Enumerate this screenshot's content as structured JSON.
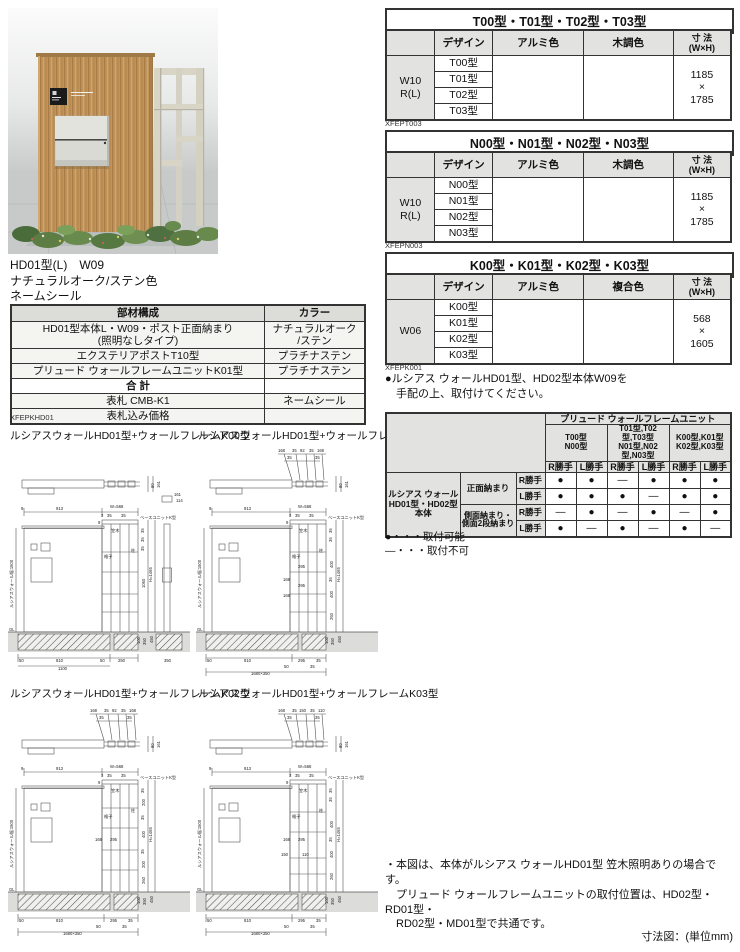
{
  "photo": {
    "caption_line1": "HD01型(L)　W09",
    "caption_line2": "ナチュラルオーク/ステン色",
    "caption_line3": "ネームシール"
  },
  "spec_tables": [
    {
      "title": "T00型・T01型・T02型・T03型",
      "headers": {
        "design": "デザイン",
        "alumi": "アルミ色",
        "wood": "木調色",
        "size": "寸 法\n(W×H)"
      },
      "row_label": "W10\nR(L)",
      "designs": [
        "T00型",
        "T01型",
        "T02型",
        "T03型"
      ],
      "size": "1185\n×\n1785",
      "code": "XFEPT003"
    },
    {
      "title": "N00型・N01型・N02型・N03型",
      "headers": {
        "design": "デザイン",
        "alumi": "アルミ色",
        "wood": "木調色",
        "size": "寸 法\n(W×H)"
      },
      "row_label": "W10\nR(L)",
      "designs": [
        "N00型",
        "N01型",
        "N02型",
        "N03型"
      ],
      "size": "1185\n×\n1785",
      "code": "XFEPN003"
    },
    {
      "title": "K00型・K01型・K02型・K03型",
      "headers": {
        "design": "デザイン",
        "alumi": "アルミ色",
        "wood": "複合色",
        "size": "寸 法\n(W×H)"
      },
      "row_label": "W06",
      "designs": [
        "K00型",
        "K01型",
        "K02型",
        "K03型"
      ],
      "size": "568\n×\n1605",
      "code": "XFEPK001"
    }
  ],
  "order_note": "●ルシアス ウォールHD01型、HD02型本体W09を\n　手配の上、取付けてください。",
  "parts_table": {
    "headers": {
      "parts": "部材構成",
      "color": "カラー"
    },
    "rows": [
      {
        "name": "HD01型本体L・W09・ポスト正面納まり\n(照明なしタイプ)",
        "color": "ナチュラルオーク\n/ステン"
      },
      {
        "name": "エクステリアポストT10型",
        "color": "プラチナステン"
      },
      {
        "name": "プリュード ウォールフレームユニットK01型",
        "color": "プラチナステン"
      },
      {
        "name": "合 計",
        "color": ""
      },
      {
        "name": "表札 CMB-K1",
        "color": "ネームシール"
      },
      {
        "name": "表札込み価格",
        "color": ""
      }
    ],
    "code": "XFEPKHD01"
  },
  "compat": {
    "title": "プリュード ウォールフレームユニット",
    "groups": [
      "T00型\nN00型",
      "T01型,T02型,T03型\nN01型,N02型,N03型",
      "K00型,K01型\nK02型,K03型"
    ],
    "hands": [
      "R勝手",
      "L勝手",
      "R勝手",
      "L勝手",
      "R勝手",
      "L勝手"
    ],
    "body_label": "ルシアス ウォール\nHD01型・HD02型\n本体",
    "mount_front": "正面納まり",
    "mount_side": "側面納まり・\n側面2段納まり",
    "rows": [
      {
        "hand": "R勝手",
        "cells": [
          "●",
          "●",
          "―",
          "●",
          "●",
          "●"
        ]
      },
      {
        "hand": "L勝手",
        "cells": [
          "●",
          "●",
          "●",
          "―",
          "●",
          "●"
        ]
      },
      {
        "hand": "R勝手",
        "cells": [
          "―",
          "●",
          "―",
          "●",
          "―",
          "●"
        ]
      },
      {
        "hand": "L勝手",
        "cells": [
          "●",
          "―",
          "●",
          "―",
          "●",
          "―"
        ]
      }
    ],
    "legend_ok": "●・・・取付可能",
    "legend_ng": "―・・・取付不可"
  },
  "drawings": [
    {
      "title": "ルシアスウォールHD01型+ウォールフレームK00型",
      "texts": [
        {
          "t": "80",
          "x": 146,
          "y": 48,
          "r": -90
        },
        {
          "t": "161",
          "x": 152,
          "y": 48,
          "r": -90
        },
        {
          "t": "161",
          "x": 166,
          "y": 56
        },
        {
          "t": "114",
          "x": 168,
          "y": 62
        },
        {
          "t": "9",
          "x": 13,
          "y": 70
        },
        {
          "t": "913",
          "x": 48,
          "y": 70
        },
        {
          "t": "W=568",
          "x": 102,
          "y": 68
        },
        {
          "t": "3",
          "x": 93,
          "y": 77
        },
        {
          "t": "35",
          "x": 99,
          "y": 77
        },
        {
          "t": "35",
          "x": 113,
          "y": 77
        },
        {
          "t": "9",
          "x": 90,
          "y": 84
        },
        {
          "t": "笠木",
          "x": 103,
          "y": 92,
          "s": 3.6
        },
        {
          "t": "ベースユニットK型",
          "x": 132,
          "y": 79,
          "s": 3.3
        },
        {
          "t": "格子",
          "x": 96,
          "y": 118,
          "s": 3.6
        },
        {
          "t": "柱",
          "x": 123,
          "y": 112,
          "s": 3.6
        },
        {
          "t": "35",
          "x": 136,
          "y": 93,
          "r": -90,
          "s": 3.5
        },
        {
          "t": "35",
          "x": 136,
          "y": 102,
          "r": -90,
          "s": 3.5
        },
        {
          "t": "35",
          "x": 136,
          "y": 111,
          "r": -90,
          "s": 3.5
        },
        {
          "t": "1060",
          "x": 137,
          "y": 148,
          "r": -90
        },
        {
          "t": "H=1465",
          "x": 144,
          "y": 142,
          "r": -90
        },
        {
          "t": "100",
          "x": 132,
          "y": 204,
          "r": -90,
          "s": 3.3
        },
        {
          "t": "350",
          "x": 138,
          "y": 205,
          "r": -90,
          "s": 3.5
        },
        {
          "t": "450",
          "x": 145,
          "y": 203,
          "r": -90,
          "s": 3.5
        },
        {
          "t": "GL",
          "x": 1,
          "y": 191,
          "s": 3.8
        },
        {
          "t": "ルシアスウォール幅:1500",
          "x": 5,
          "y": 168,
          "r": -90,
          "s": 3.3
        },
        {
          "t": "50",
          "x": 11,
          "y": 222
        },
        {
          "t": "810",
          "x": 48,
          "y": 222
        },
        {
          "t": "50",
          "x": 92,
          "y": 222
        },
        {
          "t": "1100",
          "x": 50,
          "y": 230
        },
        {
          "t": "250",
          "x": 110,
          "y": 222
        },
        {
          "t": "350",
          "x": 156,
          "y": 222
        }
      ]
    },
    {
      "title": "ルシアスウォールHD01型+ウォールフレームK01型",
      "texts": [
        {
          "t": "168",
          "x": 82,
          "y": 12
        },
        {
          "t": "35",
          "x": 96,
          "y": 12
        },
        {
          "t": "92",
          "x": 104,
          "y": 12
        },
        {
          "t": "35",
          "x": 113,
          "y": 12
        },
        {
          "t": "168",
          "x": 121,
          "y": 12
        },
        {
          "t": "35",
          "x": 91,
          "y": 19
        },
        {
          "t": "35",
          "x": 119,
          "y": 19
        },
        {
          "t": "80",
          "x": 146,
          "y": 48,
          "r": -90
        },
        {
          "t": "161",
          "x": 152,
          "y": 48,
          "r": -90
        },
        {
          "t": "9",
          "x": 13,
          "y": 70
        },
        {
          "t": "913",
          "x": 48,
          "y": 70
        },
        {
          "t": "W=568",
          "x": 102,
          "y": 68
        },
        {
          "t": "3",
          "x": 93,
          "y": 77
        },
        {
          "t": "35",
          "x": 99,
          "y": 77
        },
        {
          "t": "35",
          "x": 113,
          "y": 77
        },
        {
          "t": "9",
          "x": 90,
          "y": 84
        },
        {
          "t": "笠木",
          "x": 103,
          "y": 92,
          "s": 3.6
        },
        {
          "t": "ベースユニットK型",
          "x": 132,
          "y": 79,
          "s": 3.3
        },
        {
          "t": "格子",
          "x": 96,
          "y": 118,
          "s": 3.6
        },
        {
          "t": "柱",
          "x": 123,
          "y": 112,
          "s": 3.6
        },
        {
          "t": "295",
          "x": 102,
          "y": 128
        },
        {
          "t": "168",
          "x": 87,
          "y": 141
        },
        {
          "t": "295",
          "x": 102,
          "y": 147
        },
        {
          "t": "168",
          "x": 87,
          "y": 157
        },
        {
          "t": "35",
          "x": 136,
          "y": 93,
          "r": -90,
          "s": 3.4
        },
        {
          "t": "35",
          "x": 136,
          "y": 102,
          "r": -90,
          "s": 3.4
        },
        {
          "t": "400",
          "x": 137,
          "y": 128,
          "r": -90,
          "s": 3.6
        },
        {
          "t": "35",
          "x": 136,
          "y": 142,
          "r": -90,
          "s": 3.4
        },
        {
          "t": "400",
          "x": 137,
          "y": 158,
          "r": -90,
          "s": 3.6
        },
        {
          "t": "260",
          "x": 137,
          "y": 180,
          "r": -90,
          "s": 3.6
        },
        {
          "t": "H=1465",
          "x": 144,
          "y": 142,
          "r": -90
        },
        {
          "t": "100",
          "x": 132,
          "y": 204,
          "r": -90,
          "s": 3.3
        },
        {
          "t": "350",
          "x": 138,
          "y": 205,
          "r": -90,
          "s": 3.5
        },
        {
          "t": "450",
          "x": 145,
          "y": 203,
          "r": -90,
          "s": 3.5
        },
        {
          "t": "GL",
          "x": 1,
          "y": 191,
          "s": 3.8
        },
        {
          "t": "ルシアスウォール幅:1500",
          "x": 5,
          "y": 168,
          "r": -90,
          "s": 3.3
        },
        {
          "t": "50",
          "x": 11,
          "y": 222
        },
        {
          "t": "810",
          "x": 48,
          "y": 222
        },
        {
          "t": "295",
          "x": 102,
          "y": 222
        },
        {
          "t": "35",
          "x": 120,
          "y": 222
        },
        {
          "t": "50",
          "x": 88,
          "y": 228
        },
        {
          "t": "35",
          "x": 114,
          "y": 228
        },
        {
          "t": "1680×350",
          "x": 55,
          "y": 235
        }
      ]
    },
    {
      "title": "ルシアスウォールHD01型+ウォールフレームK02型",
      "texts": [
        {
          "t": "168",
          "x": 82,
          "y": 12
        },
        {
          "t": "35",
          "x": 96,
          "y": 12
        },
        {
          "t": "92",
          "x": 104,
          "y": 12
        },
        {
          "t": "35",
          "x": 113,
          "y": 12
        },
        {
          "t": "168",
          "x": 121,
          "y": 12
        },
        {
          "t": "35",
          "x": 91,
          "y": 19
        },
        {
          "t": "35",
          "x": 119,
          "y": 19
        },
        {
          "t": "80",
          "x": 146,
          "y": 48,
          "r": -90
        },
        {
          "t": "161",
          "x": 152,
          "y": 48,
          "r": -90
        },
        {
          "t": "9",
          "x": 13,
          "y": 70
        },
        {
          "t": "913",
          "x": 48,
          "y": 70
        },
        {
          "t": "W=568",
          "x": 102,
          "y": 68
        },
        {
          "t": "3",
          "x": 93,
          "y": 77
        },
        {
          "t": "35",
          "x": 99,
          "y": 77
        },
        {
          "t": "35",
          "x": 113,
          "y": 77
        },
        {
          "t": "9",
          "x": 90,
          "y": 84
        },
        {
          "t": "笠木",
          "x": 103,
          "y": 92,
          "s": 3.6
        },
        {
          "t": "ベースユニットK型",
          "x": 132,
          "y": 79,
          "s": 3.3
        },
        {
          "t": "格子",
          "x": 96,
          "y": 118,
          "s": 3.6
        },
        {
          "t": "柱",
          "x": 123,
          "y": 112,
          "s": 3.6
        },
        {
          "t": "168",
          "x": 87,
          "y": 141
        },
        {
          "t": "295",
          "x": 102,
          "y": 141
        },
        {
          "t": "35",
          "x": 136,
          "y": 93,
          "r": -90,
          "s": 3.4
        },
        {
          "t": "200",
          "x": 137,
          "y": 106,
          "r": -90,
          "s": 3.6
        },
        {
          "t": "35",
          "x": 136,
          "y": 120,
          "r": -90,
          "s": 3.4
        },
        {
          "t": "400",
          "x": 137,
          "y": 138,
          "r": -90,
          "s": 3.6
        },
        {
          "t": "35",
          "x": 136,
          "y": 154,
          "r": -90,
          "s": 3.4
        },
        {
          "t": "200",
          "x": 137,
          "y": 168,
          "r": -90,
          "s": 3.6
        },
        {
          "t": "260",
          "x": 137,
          "y": 184,
          "r": -90,
          "s": 3.6
        },
        {
          "t": "H=1465",
          "x": 144,
          "y": 142,
          "r": -90
        },
        {
          "t": "100",
          "x": 132,
          "y": 204,
          "r": -90,
          "s": 3.3
        },
        {
          "t": "350",
          "x": 138,
          "y": 205,
          "r": -90,
          "s": 3.5
        },
        {
          "t": "450",
          "x": 145,
          "y": 203,
          "r": -90,
          "s": 3.5
        },
        {
          "t": "GL",
          "x": 1,
          "y": 191,
          "s": 3.8
        },
        {
          "t": "ルシアスウォール幅:1500",
          "x": 5,
          "y": 168,
          "r": -90,
          "s": 3.3
        },
        {
          "t": "50",
          "x": 11,
          "y": 222
        },
        {
          "t": "810",
          "x": 48,
          "y": 222
        },
        {
          "t": "295",
          "x": 102,
          "y": 222
        },
        {
          "t": "35",
          "x": 120,
          "y": 222
        },
        {
          "t": "50",
          "x": 88,
          "y": 228
        },
        {
          "t": "35",
          "x": 114,
          "y": 228
        },
        {
          "t": "1680×350",
          "x": 55,
          "y": 235
        }
      ]
    },
    {
      "title": "ルシアスウォールHD01型+ウォールフレームK03型",
      "texts": [
        {
          "t": "168",
          "x": 82,
          "y": 12
        },
        {
          "t": "35",
          "x": 96,
          "y": 12
        },
        {
          "t": "150",
          "x": 103,
          "y": 12
        },
        {
          "t": "35",
          "x": 114,
          "y": 12
        },
        {
          "t": "110",
          "x": 122,
          "y": 12
        },
        {
          "t": "35",
          "x": 91,
          "y": 19
        },
        {
          "t": "35",
          "x": 119,
          "y": 19
        },
        {
          "t": "80",
          "x": 146,
          "y": 48,
          "r": -90
        },
        {
          "t": "161",
          "x": 152,
          "y": 48,
          "r": -90
        },
        {
          "t": "9",
          "x": 13,
          "y": 70
        },
        {
          "t": "913",
          "x": 48,
          "y": 70
        },
        {
          "t": "W=568",
          "x": 102,
          "y": 68
        },
        {
          "t": "3",
          "x": 93,
          "y": 77
        },
        {
          "t": "35",
          "x": 99,
          "y": 77
        },
        {
          "t": "35",
          "x": 113,
          "y": 77
        },
        {
          "t": "9",
          "x": 90,
          "y": 84
        },
        {
          "t": "笠木",
          "x": 103,
          "y": 92,
          "s": 3.6
        },
        {
          "t": "ベースユニットK型",
          "x": 132,
          "y": 79,
          "s": 3.3
        },
        {
          "t": "格子",
          "x": 96,
          "y": 118,
          "s": 3.6
        },
        {
          "t": "柱",
          "x": 123,
          "y": 112,
          "s": 3.6
        },
        {
          "t": "168",
          "x": 87,
          "y": 141
        },
        {
          "t": "295",
          "x": 102,
          "y": 141
        },
        {
          "t": "150",
          "x": 85,
          "y": 156
        },
        {
          "t": "110",
          "x": 106,
          "y": 156
        },
        {
          "t": "35",
          "x": 136,
          "y": 93,
          "r": -90,
          "s": 3.4
        },
        {
          "t": "35",
          "x": 136,
          "y": 102,
          "r": -90,
          "s": 3.4
        },
        {
          "t": "400",
          "x": 137,
          "y": 128,
          "r": -90,
          "s": 3.6
        },
        {
          "t": "35",
          "x": 136,
          "y": 142,
          "r": -90,
          "s": 3.4
        },
        {
          "t": "400",
          "x": 137,
          "y": 158,
          "r": -90,
          "s": 3.6
        },
        {
          "t": "260",
          "x": 137,
          "y": 180,
          "r": -90,
          "s": 3.6
        },
        {
          "t": "H=1465",
          "x": 144,
          "y": 142,
          "r": -90
        },
        {
          "t": "100",
          "x": 132,
          "y": 204,
          "r": -90,
          "s": 3.3
        },
        {
          "t": "350",
          "x": 138,
          "y": 205,
          "r": -90,
          "s": 3.5
        },
        {
          "t": "450",
          "x": 145,
          "y": 203,
          "r": -90,
          "s": 3.5
        },
        {
          "t": "GL",
          "x": 1,
          "y": 191,
          "s": 3.8
        },
        {
          "t": "ルシアスウォール幅:1500",
          "x": 5,
          "y": 168,
          "r": -90,
          "s": 3.3
        },
        {
          "t": "50",
          "x": 11,
          "y": 222
        },
        {
          "t": "810",
          "x": 48,
          "y": 222
        },
        {
          "t": "295",
          "x": 102,
          "y": 222
        },
        {
          "t": "35",
          "x": 120,
          "y": 222
        },
        {
          "t": "50",
          "x": 88,
          "y": 228
        },
        {
          "t": "35",
          "x": 114,
          "y": 228
        },
        {
          "t": "1680×350",
          "x": 55,
          "y": 235
        }
      ]
    }
  ],
  "notes": "・本図は、本体がルシアス ウォールHD01型 笠木照明ありの場合です。\n　プリュード ウォールフレームユニットの取付位置は、HD02型・RD01型・\n　RD02型・MD01型で共通です。",
  "footer": "寸法図：(単位mm)"
}
